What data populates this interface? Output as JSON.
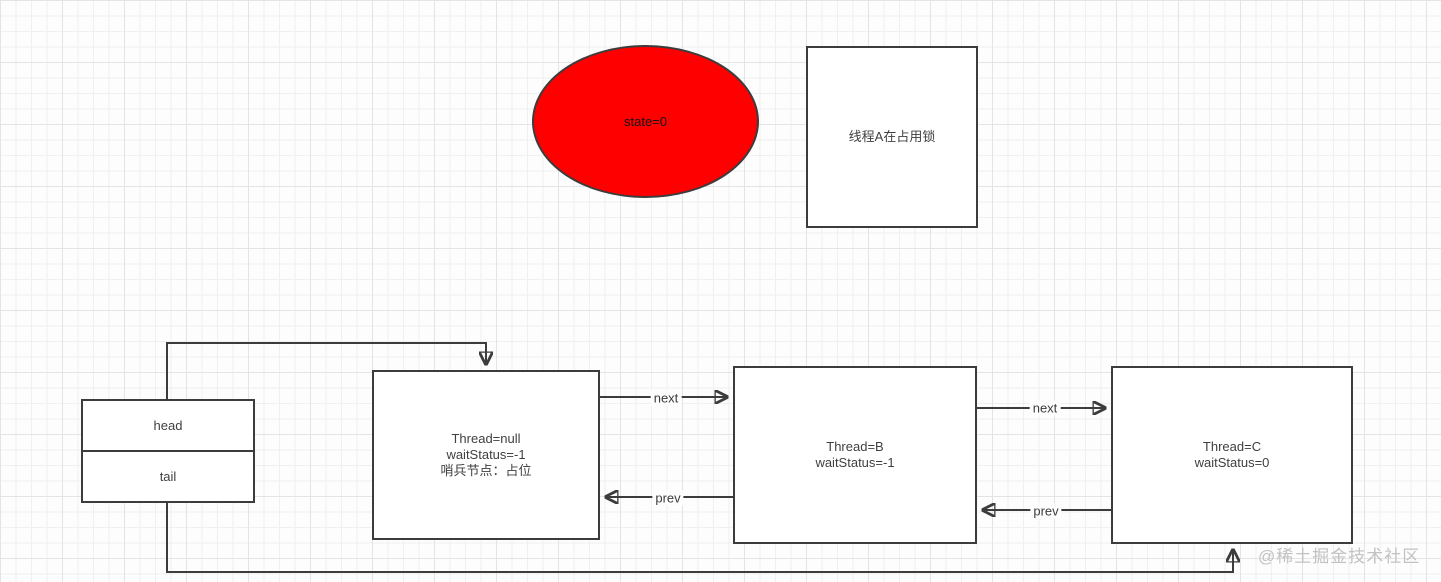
{
  "colors": {
    "state_ellipse_fill": "#fe0000",
    "line": "#3c3c3c",
    "node_fill": "#ffffff",
    "node_text": "#3f3f3f",
    "watermark": "#c2c2c2"
  },
  "diagram": {
    "state_ellipse": {
      "label": "state=0"
    },
    "thread_a_box": {
      "label": "线程A在占用锁"
    },
    "pointer_box": {
      "head": "head",
      "tail": "tail"
    },
    "nodes": {
      "sentinel": {
        "lines": [
          "Thread=null",
          "waitStatus=-1",
          "哨兵节点：占位"
        ]
      },
      "node_b": {
        "lines": [
          "Thread=B",
          "waitStatus=-1"
        ]
      },
      "node_c": {
        "lines": [
          "Thread=C",
          "waitStatus=0"
        ]
      }
    },
    "edge_labels": {
      "next": "next",
      "prev": "prev"
    },
    "watermark": "@稀土掘金技术社区"
  }
}
